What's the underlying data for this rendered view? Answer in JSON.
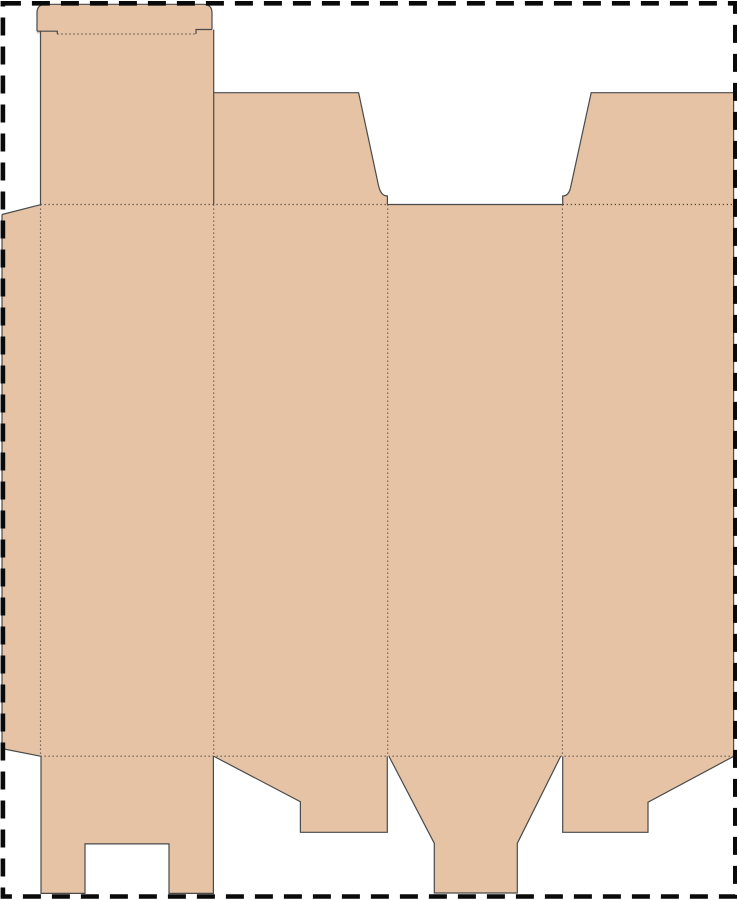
{
  "meta": {
    "description": "folding-carton box dieline template (flat die-cut blank)",
    "canvas_width": 737,
    "canvas_height": 900,
    "background": "#ffffff"
  },
  "colors": {
    "board_fill": "#e5c3a4",
    "cut_line": "#4a4a4a",
    "fold_line": "#4f4f4f",
    "page_border": "#0a0a0a"
  },
  "styles": {
    "cut_width": 1.2,
    "fold_width": 1.15,
    "fold_dash": "1.3 2.7",
    "border_width": 4.6,
    "border_dash": "18 11"
  },
  "page_border": {
    "x": 2.9,
    "y": 3.3,
    "width": 732.4,
    "height": 893.2
  },
  "pieces": [
    {
      "name": "tuck-lid-tongue",
      "path": "M 37 33.5 L 37 13 Q 37 4.3 46 4.3 L 203 4.3 Q 212 4.3 212 13 L 212 33.5 Z"
    },
    {
      "name": "tuck-lid-neck",
      "path": "M 40.5 30 L 213.7 30 L 213.7 205 L 40.5 205 Z"
    },
    {
      "name": "glue-flap",
      "path": "M 2 214.5 L 40.9 204.6 L 40.9 756.2 L 2 748.6 Z"
    },
    {
      "name": "main-panels-band",
      "path": "M 40.5 204.5 L 733.6 204.5 L 733.6 756.2 L 40.5 756.2 Z"
    },
    {
      "name": "top-flap-panel2",
      "path": "M 213.7 92.7 L 358.6 92.7 L 378.5 185.5 Q 380.8 196 387.4 196 L 387.4 205 L 213.7 205 Z"
    },
    {
      "name": "top-flap-panel4",
      "path": "M 591.2 92.7 L 733.6 92.7 L 733.6 205 L 562.7 205 L 562.7 196 Q 569.3 196 571 185.5 Z"
    },
    {
      "name": "bottom-flap-panel1",
      "path": "M 41 756 L 213.4 756 L 213.4 893.4 L 169 893.4 L 169 843.9 L 85 843.9 L 85 893.4 L 41 893.4 Z"
    },
    {
      "name": "bottom-flap-panel2",
      "path": "M 214 756 L 387.3 756 L 387.3 832.3 L 300.4 832.3 L 300.4 801.7 Z"
    },
    {
      "name": "bottom-flap-panel3",
      "path": "M 389 756 L 560.6 756 L 517.3 843.3 L 517.3 893 L 434.3 893 L 434.3 843.3 Z"
    },
    {
      "name": "bottom-flap-panel4",
      "path": "M 562.7 756 L 733.6 756 L 648 802.2 L 648 832.3 L 562.7 832.3 Z"
    }
  ],
  "cut_edges": [
    {
      "name": "tongue-outline-cut",
      "path": "M 37 31.2 L 37 13 Q 37 4.3 46 4.3 L 203 4.3 Q 212 4.3 212 13 L 212 29.5"
    },
    {
      "name": "tongue-slit-left-cut",
      "path": "M 37 31.2 L 57.3 31.2 L 57.3 34"
    },
    {
      "name": "tongue-slit-right-cut",
      "path": "M 212 29.5 L 196 29.5 L 196 34"
    },
    {
      "name": "tuck-neck-left-cut",
      "path": "M 40.5 31.2 L 40.5 204.5"
    },
    {
      "name": "tuck-neck-right-cut",
      "path": "M 213.7 29.5 L 213.7 204.5"
    },
    {
      "name": "glue-flap-top-cut",
      "path": "M 2 214.5 L 40.5 204.7"
    },
    {
      "name": "glue-flap-left-cut",
      "path": "M 2 214.5 L 2 748.6"
    },
    {
      "name": "glue-flap-bottom-cut",
      "path": "M 2 748.6 L 40.5 756.2"
    },
    {
      "name": "top-flap2-cut",
      "path": "M 213.7 92.7 L 358.6 92.7 L 378.5 185.5 Q 380.8 196 387.4 196 L 387.4 204.5"
    },
    {
      "name": "panel3-top-cut",
      "path": "M 387.4 204.5 L 562.7 204.5"
    },
    {
      "name": "top-flap4-cut",
      "path": "M 733.6 92.7 L 591.2 92.7 L 571 185.5 Q 569.3 196 562.7 196 L 562.7 204.5"
    },
    {
      "name": "right-edge-cut",
      "path": "M 733.6 92.7 L 733.6 756"
    },
    {
      "name": "bottom-flap1-cut",
      "path": "M 41 756 L 41 893.4 L 85 893.4 L 85 843.9 L 169 843.9 L 169 893.4 L 213.4 893.4 L 213.4 756"
    },
    {
      "name": "bottom-flap2-cut",
      "path": "M 214 756.4 L 300.4 801.7 L 300.4 832.3 L 387.3 832.3 L 387.3 756.4"
    },
    {
      "name": "bottom-flap3-cut",
      "path": "M 389 756.4 L 434.3 843.3 L 434.3 893 L 517.3 893 L 517.3 843.3 L 560.6 756.4"
    },
    {
      "name": "bottom-flap4-cut",
      "path": "M 562.7 756.4 L 562.7 832.3 L 648 832.3 L 648 802.2 L 733.6 756.4"
    }
  ],
  "fold_lines": [
    {
      "name": "tuck-lid-fold",
      "x1": 57.3,
      "y1": 34,
      "x2": 195.7,
      "y2": 34
    },
    {
      "name": "top-fold-left",
      "x1": 40.5,
      "y1": 204.5,
      "x2": 387.4,
      "y2": 204.5
    },
    {
      "name": "top-fold-right",
      "x1": 562.7,
      "y1": 204.5,
      "x2": 733.6,
      "y2": 204.5
    },
    {
      "name": "bottom-fold",
      "x1": 40.5,
      "y1": 756.2,
      "x2": 733.6,
      "y2": 756.2
    },
    {
      "name": "glue-flap-fold",
      "x1": 40.5,
      "y1": 204.5,
      "x2": 40.5,
      "y2": 756.2
    },
    {
      "name": "panel1-panel2-fold",
      "x1": 213.7,
      "y1": 204.5,
      "x2": 213.7,
      "y2": 756.2
    },
    {
      "name": "panel2-panel3-fold",
      "x1": 387.7,
      "y1": 204.5,
      "x2": 387.7,
      "y2": 756.2
    },
    {
      "name": "panel3-panel4-fold",
      "x1": 562.4,
      "y1": 204.5,
      "x2": 562.4,
      "y2": 756.2
    }
  ]
}
